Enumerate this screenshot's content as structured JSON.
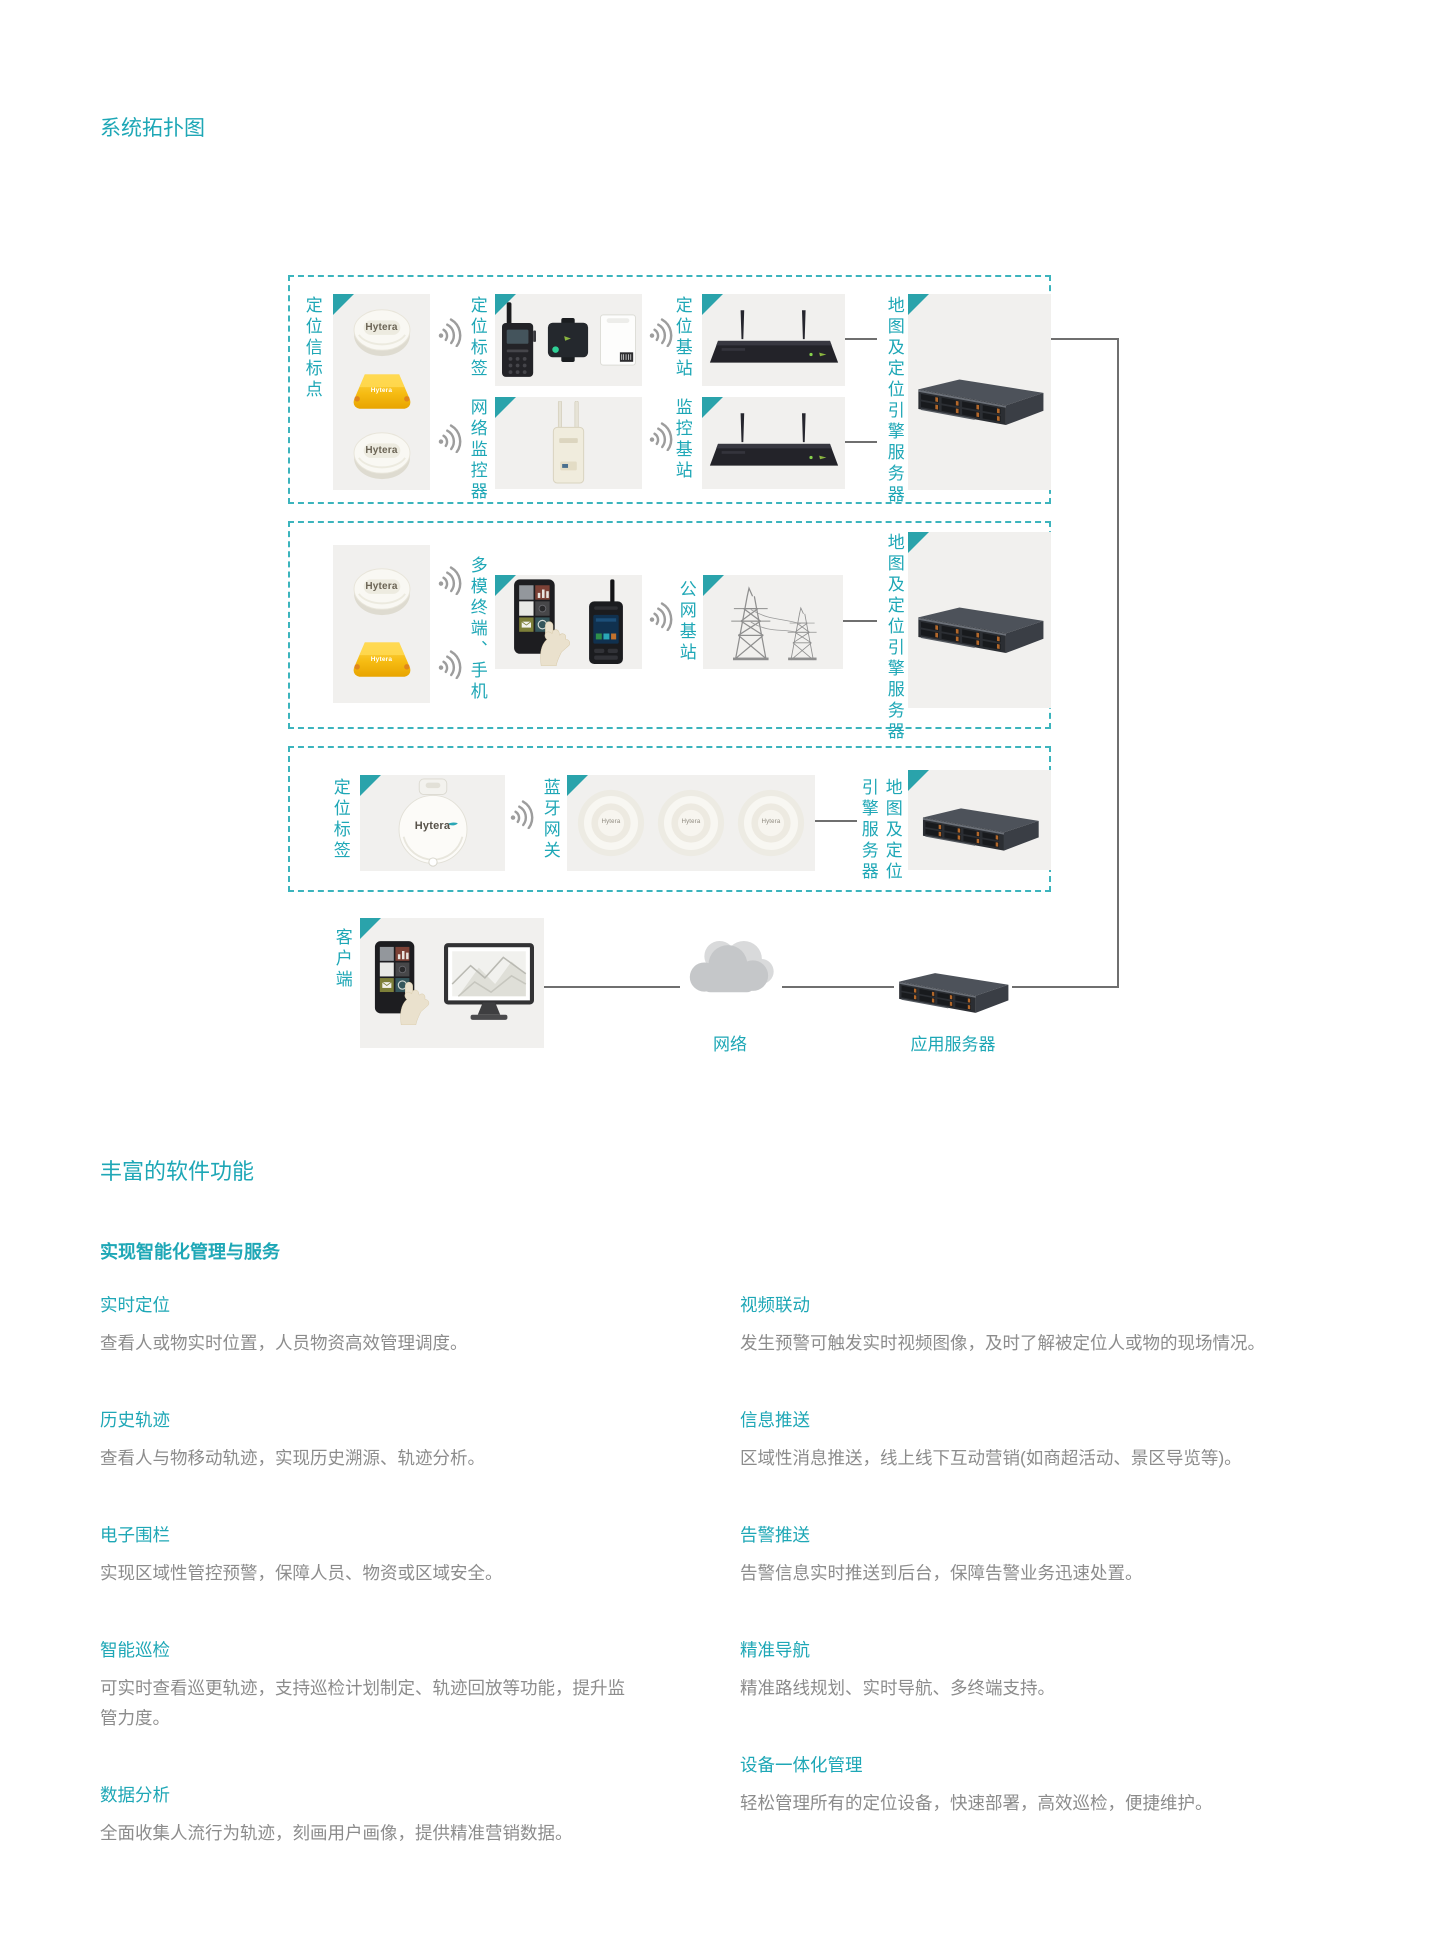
{
  "page": {
    "title": "系统拓扑图"
  },
  "brand": "Hytera",
  "colors": {
    "teal": "#1ea7b6",
    "triangle": "#2aa3ab",
    "line_gray": "#6f6f6f",
    "desc_gray": "#8c8c8c"
  },
  "topology": {
    "box1": {
      "beacons_label": "定位信标点",
      "tag_label": "定位标签",
      "positioning_station_label": "定位基站",
      "monitor_label": "网络监控器",
      "monitoring_station_label": "监控基站",
      "server_label": "地图及定位引擎服务器"
    },
    "box2": {
      "terminal_label": "多模终端、手机",
      "public_station_label": "公网基站",
      "server_label": "地图及定位引擎服务器"
    },
    "box3": {
      "tag_label": "定位标签",
      "gateway_label": "蓝牙网关",
      "server_label_col_right": "地图及定位",
      "server_label_col_left": "引擎服务器"
    },
    "client_label": "客户端",
    "network_label": "网络",
    "app_server_label": "应用服务器"
  },
  "features": {
    "title": "丰富的软件功能",
    "subtitle": "实现智能化管理与服务",
    "left": [
      {
        "title": "实时定位",
        "desc": "查看人或物实时位置，人员物资高效管理调度。"
      },
      {
        "title": "历史轨迹",
        "desc": "查看人与物移动轨迹，实现历史溯源、轨迹分析。"
      },
      {
        "title": "电子围栏",
        "desc": "实现区域性管控预警，保障人员、物资或区域安全。"
      },
      {
        "title": "智能巡检",
        "desc": "可实时查看巡更轨迹，支持巡检计划制定、轨迹回放等功能，提升监管力度。"
      },
      {
        "title": "数据分析",
        "desc": "全面收集人流行为轨迹，刻画用户画像，提供精准营销数据。"
      }
    ],
    "right": [
      {
        "title": "视频联动",
        "desc": "发生预警可触发实时视频图像，及时了解被定位人或物的现场情况。"
      },
      {
        "title": "信息推送",
        "desc": "区域性消息推送，线上线下互动营销(如商超活动、景区导览等)。"
      },
      {
        "title": "告警推送",
        "desc": "告警信息实时推送到后台，保障告警业务迅速处置。"
      },
      {
        "title": "精准导航",
        "desc": "精准路线规划、实时导航、多终端支持。"
      },
      {
        "title": "设备一体化管理",
        "desc": "轻松管理所有的定位设备，快速部署，高效巡检，便捷维护。"
      }
    ]
  }
}
